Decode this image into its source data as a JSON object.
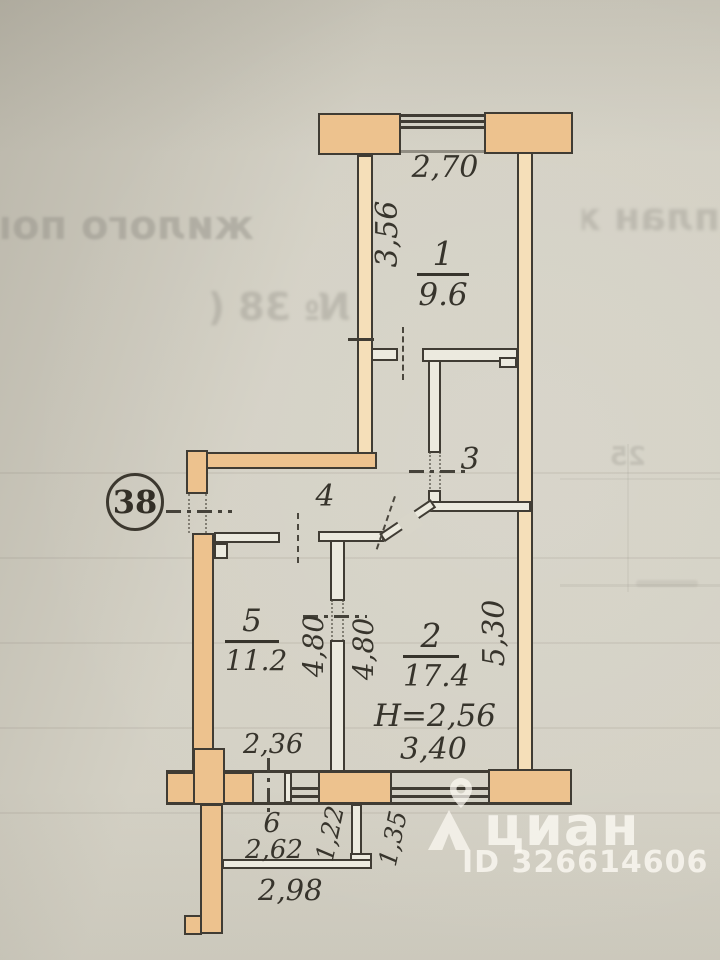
{
  "plan": {
    "apartment_number": "38",
    "ceiling_height_note": "Н=2,56",
    "rooms": [
      {
        "number": "1",
        "area": "9.6"
      },
      {
        "number": "2",
        "area": "17.4"
      },
      {
        "number": "3"
      },
      {
        "number": "4"
      },
      {
        "number": "5",
        "area": "11.2"
      },
      {
        "number": "6"
      }
    ],
    "dimensions": {
      "d270": "2,70",
      "d356": "3,56",
      "d480_left": "4,80",
      "d480_right": "4,80",
      "d530": "5,30",
      "d340": "3,40",
      "d236": "2,36",
      "d262": "2,62",
      "d298": "2,98",
      "d122": "1,22",
      "d135": "1,35"
    }
  },
  "ghost": {
    "line1_left": "жилого пом",
    "line1_right": "план ж",
    "line2": "№ 38 (",
    "table_fragment": "25"
  },
  "watermark": {
    "brand": "циан",
    "listing_id": "ID 326614606"
  }
}
